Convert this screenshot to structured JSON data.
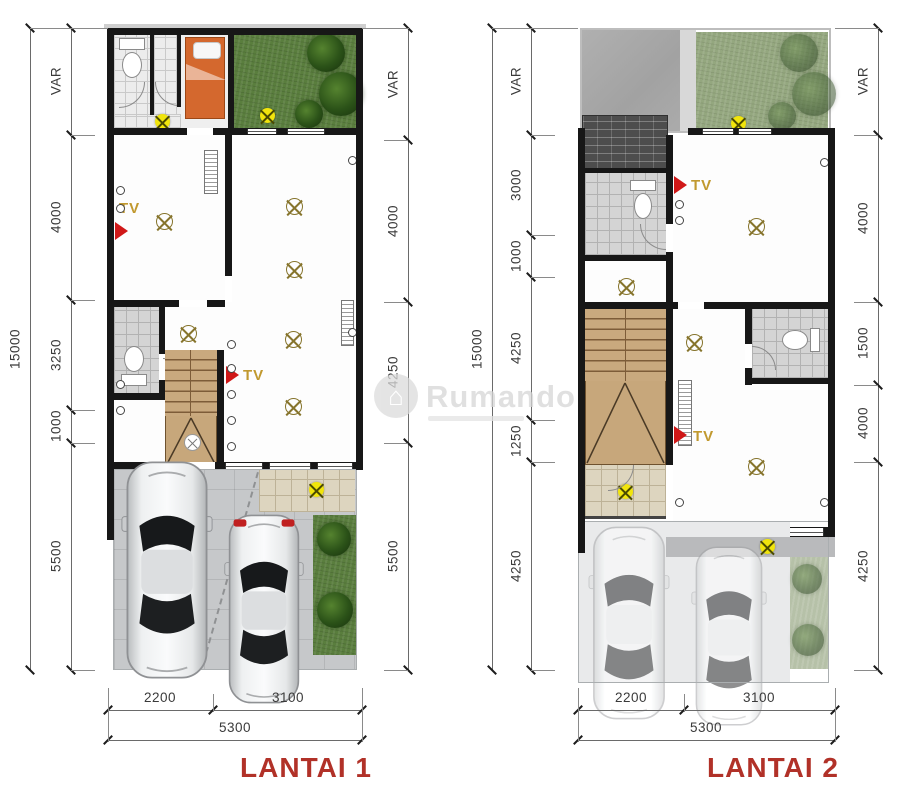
{
  "watermark": {
    "brand": "Rumando"
  },
  "colors": {
    "title_red": "#b13128",
    "tv_label_gold": "#c1992f",
    "tv_arrow_red": "#d01818",
    "marker_yellow": "#f1e50c",
    "dimension_text": "#3a3a3a",
    "wall_black": "#171717",
    "grass_green": "#5a7e3e"
  },
  "plans": [
    {
      "title": "LANTAI 1",
      "overall_height": "15000",
      "left_dims": [
        "VAR",
        "4000",
        "3250",
        "1000",
        "5500"
      ],
      "right_dims": [
        "VAR",
        "4000",
        "4250",
        "5500"
      ],
      "bottom_dims": [
        "2200",
        "3100"
      ],
      "bottom_total": "5300",
      "tv_labels": [
        "TV",
        "TV"
      ]
    },
    {
      "title": "LANTAI 2",
      "overall_height": "15000",
      "left_dims": [
        "VAR",
        "3000",
        "1000",
        "4250",
        "1250",
        "4250"
      ],
      "right_dims": [
        "VAR",
        "4000",
        "1500",
        "4000",
        "4250"
      ],
      "bottom_dims": [
        "2200",
        "3100"
      ],
      "bottom_total": "5300",
      "tv_labels": [
        "TV",
        "TV"
      ]
    }
  ]
}
